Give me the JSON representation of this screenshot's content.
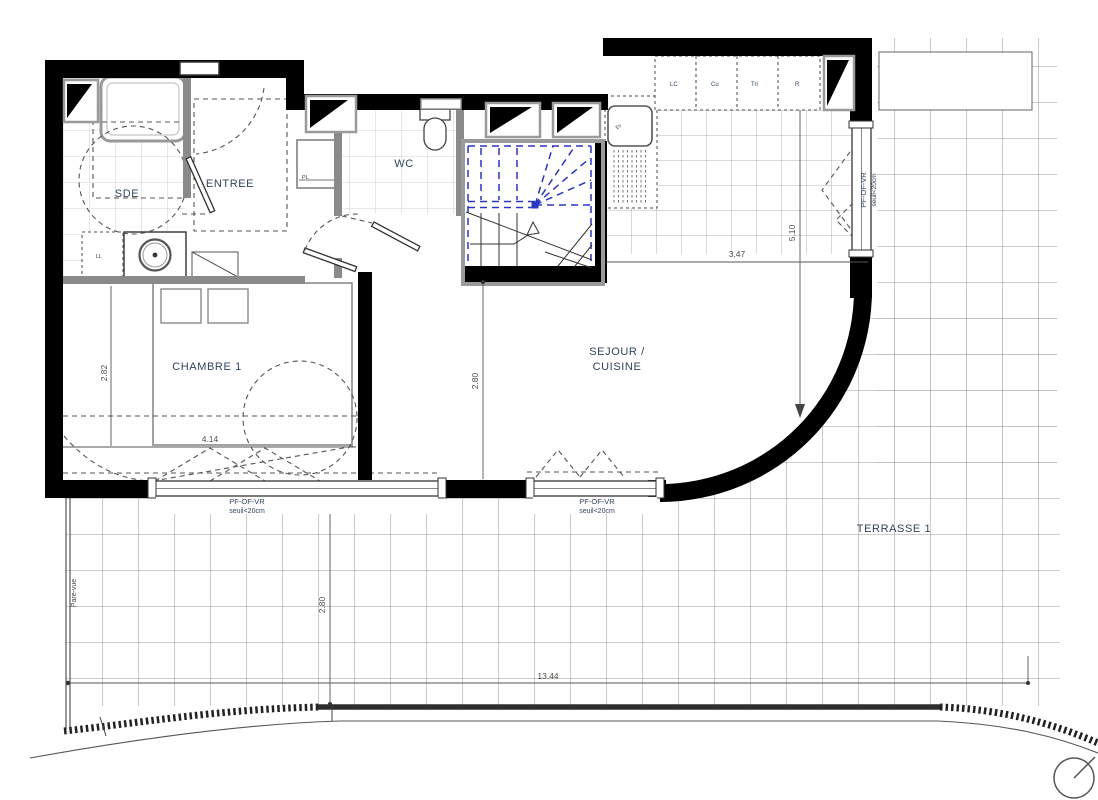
{
  "rooms": {
    "sde": "SDE",
    "entree": "ENTREE",
    "wc": "WC",
    "chambre": "CHAMBRE 1",
    "sejour_line1": "SEJOUR /",
    "sejour_line2": "CUISINE",
    "terrasse": "TERRASSE 1"
  },
  "fixtures": {
    "washer": "LL",
    "closet": "PL",
    "sink": "Ev",
    "cab1": "LC",
    "cab2": "Cu",
    "cab3": "Tri",
    "cab4": "R"
  },
  "window_label": {
    "type": "PF-OF-VR",
    "sill": "seuil<20cm"
  },
  "dimensions": {
    "chambre_width": "4.14",
    "chambre_depth": "2.82",
    "sejour_width": "3.47",
    "sejour_depth": "2.80",
    "sejour_length": "5.10",
    "terrasse_width": "13.44",
    "terrasse_depth": "2.80"
  },
  "annotations": {
    "screen": "Pare-vue"
  },
  "colors": {
    "wall": "#000000",
    "partition": "#8a8a8a",
    "stair_accent": "#2b36c0",
    "label": "#31435c",
    "dimension": "#4f4f45"
  }
}
